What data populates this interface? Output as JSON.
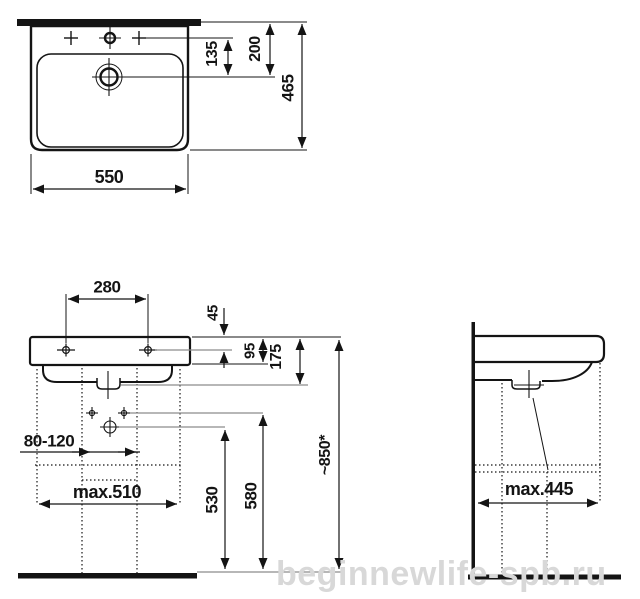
{
  "watermark": "beginnewlife-spb.ru",
  "colors": {
    "line": "#141414",
    "leader_gray": "#8c8c8c",
    "watermark_gray": "#d8d8d8",
    "background": "#ffffff"
  },
  "plan_view": {
    "description": "washbasin top view",
    "dims": {
      "width": "550",
      "depth": "465",
      "tap_to_drain": "135",
      "wall_to_drain": "200"
    }
  },
  "front_view": {
    "description": "washbasin front view with trap",
    "dims": {
      "tap_hole_spacing": "280",
      "rim_to_fixing": "45",
      "apron_height": "95",
      "rim_to_outlet": "175",
      "trap_offset_range": "80-120",
      "max_width": "max.510",
      "outlet_height": "530",
      "fixing_height": "580",
      "rim_height": "~850*"
    }
  },
  "side_view": {
    "description": "washbasin side view on wall",
    "dims": {
      "max_depth": "max.445"
    }
  }
}
